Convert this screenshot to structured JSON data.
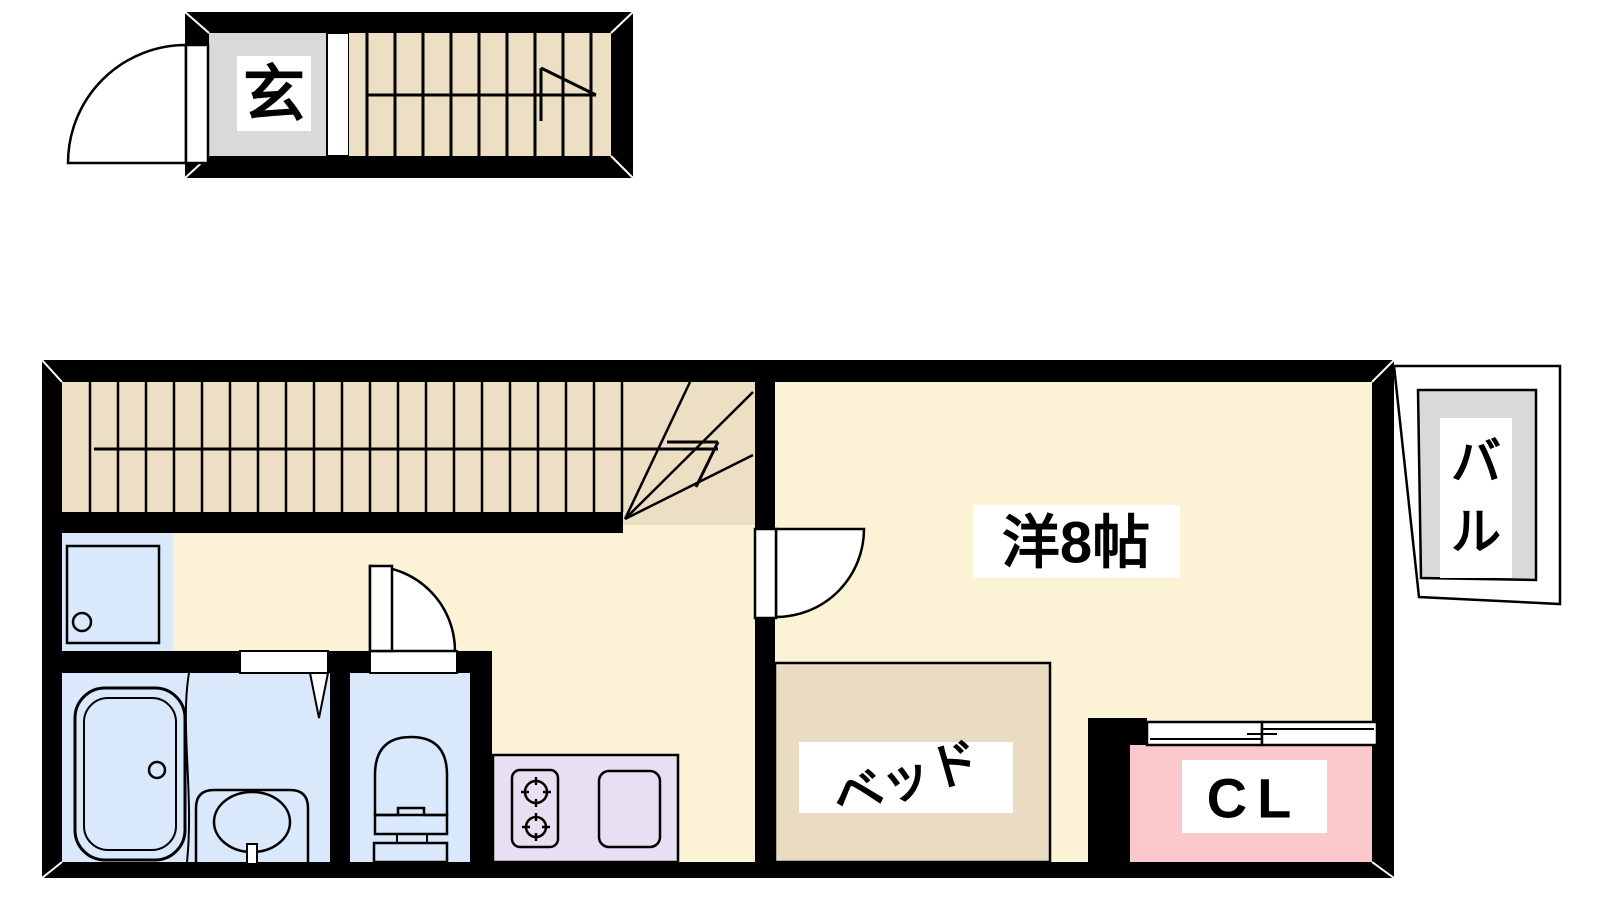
{
  "floorplan": {
    "title": "apartment-floor-plan",
    "labels": {
      "genkan": "玄",
      "western_room": "洋8帖",
      "bed": "ベッド",
      "closet": "CL",
      "balcony": [
        "バ",
        "ル"
      ]
    },
    "rooms": [
      {
        "name": "entrance",
        "label": "玄",
        "description": "genkan entry with door and staircase up"
      },
      {
        "name": "western-room",
        "label": "洋8帖",
        "description": "8-mat western style room"
      },
      {
        "name": "bed",
        "label": "ベッド",
        "description": "bed placed in western room"
      },
      {
        "name": "closet",
        "label": "CL",
        "description": "closet with sliding doors"
      },
      {
        "name": "balcony",
        "label": "バル",
        "description": "balcony outside right wall"
      },
      {
        "name": "bathroom",
        "label": "",
        "description": "bathtub and washbasin"
      },
      {
        "name": "toilet",
        "label": "",
        "description": "toilet room"
      },
      {
        "name": "kitchen",
        "label": "",
        "description": "counter with 2-burner stove and sink"
      },
      {
        "name": "laundry",
        "label": "",
        "description": "washing machine pan"
      }
    ],
    "colors": {
      "wall": "#000000",
      "floor_cream": "#FCF2D5",
      "stairs_tan": "#EDDFC4",
      "bed_tan": "#E9DCC3",
      "wet_area_blue": "#D9E8FB",
      "kitchen_lavender": "#E9DFF3",
      "closet_pink": "#FBC8CC",
      "entrance_gray": "#D9D9D9",
      "label_background": "#FFFFFF",
      "line": "#000000"
    }
  }
}
